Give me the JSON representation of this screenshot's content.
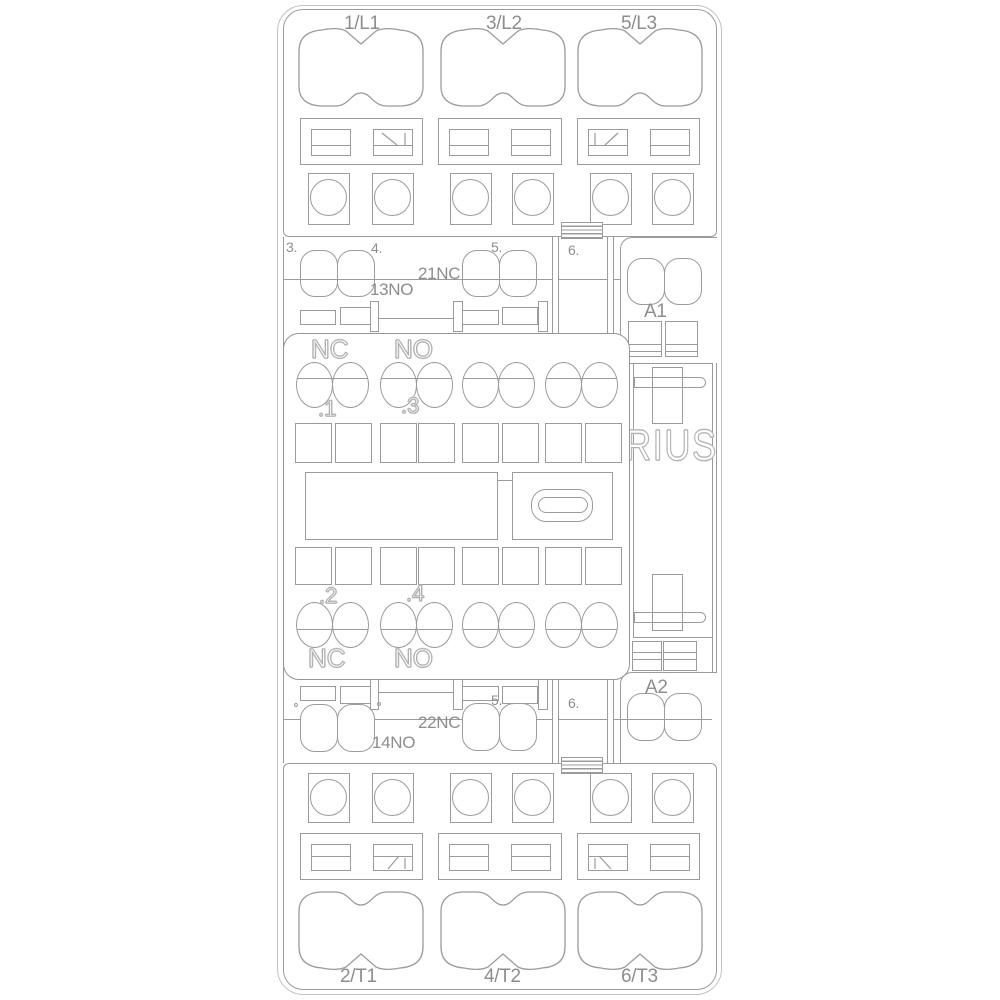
{
  "colors": {
    "line": "#9b9b9b",
    "text": "#8d8d8d",
    "engraved_outline": "#aeaeae",
    "background": "#ffffff"
  },
  "top_block": {
    "labels": [
      "1/L1",
      "3/L2",
      "5/L3"
    ]
  },
  "bottom_block": {
    "labels": [
      "2/T1",
      "4/T2",
      "6/T3"
    ]
  },
  "upper_aux": {
    "positions": [
      "3.",
      "4.",
      "5.",
      "6."
    ],
    "no_label": "13NO",
    "nc_label": "21NC",
    "coil_label": "A1"
  },
  "lower_aux": {
    "positions": [
      "5.",
      "6."
    ],
    "no_label": "14NO",
    "nc_label": "22NC",
    "coil_label": "A2"
  },
  "panel": {
    "nc_top": "NC",
    "no_top": "NO",
    "point_1": ".1",
    "point_3": ".3",
    "point_2": ".2",
    "point_4": ".4",
    "nc_bottom": "NC",
    "no_bottom": "NO"
  },
  "brand": {
    "visible_text": "RIUS"
  }
}
